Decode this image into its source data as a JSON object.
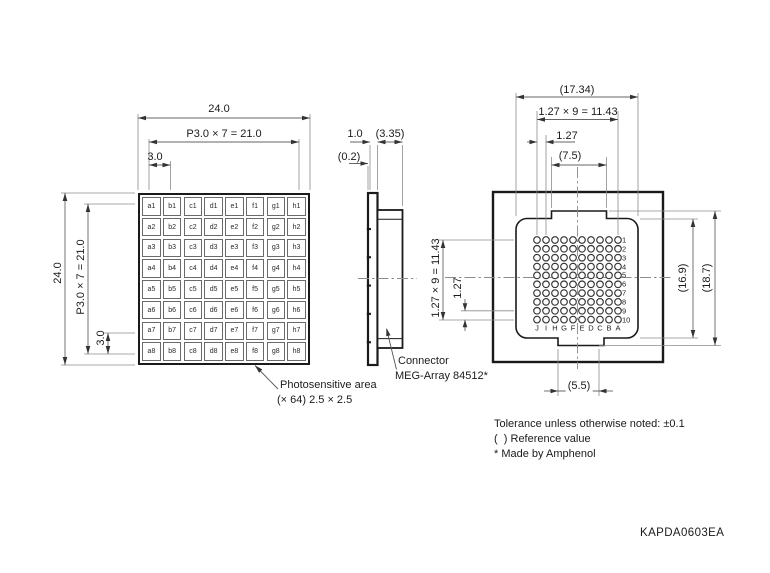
{
  "doc": {
    "drawing_number": "KAPDA0603EA",
    "notes": [
      "Tolerance unless otherwise noted: ±0.1",
      "(  ) Reference value",
      "* Made by Amphenol"
    ]
  },
  "front_view": {
    "dims_top": {
      "overall": "24.0",
      "pitch_total": "P3.0 × 7 = 21.0",
      "pitch": "3.0"
    },
    "dims_left": {
      "overall": "24.0",
      "pitch_total": "P3.0 × 7 = 21.0",
      "pitch": "3.0"
    },
    "cells": [
      [
        "a1",
        "b1",
        "c1",
        "d1",
        "e1",
        "f1",
        "g1",
        "h1"
      ],
      [
        "a2",
        "b2",
        "c2",
        "d2",
        "e2",
        "f2",
        "g2",
        "h2"
      ],
      [
        "a3",
        "b3",
        "c3",
        "d3",
        "e3",
        "f3",
        "g3",
        "h3"
      ],
      [
        "a4",
        "b4",
        "c4",
        "d4",
        "e4",
        "f4",
        "g4",
        "h4"
      ],
      [
        "a5",
        "b5",
        "c5",
        "d5",
        "e5",
        "f5",
        "g5",
        "h5"
      ],
      [
        "a6",
        "b6",
        "c6",
        "d6",
        "e6",
        "f6",
        "g6",
        "h6"
      ],
      [
        "a7",
        "b7",
        "c7",
        "d7",
        "e7",
        "f7",
        "g7",
        "h7"
      ],
      [
        "a8",
        "b8",
        "c8",
        "d8",
        "e8",
        "f8",
        "g8",
        "h8"
      ]
    ],
    "label": {
      "line1": "Photosensitive area",
      "line2": "(× 64) 2.5 × 2.5"
    }
  },
  "side_view": {
    "dims": {
      "thickness": "1.0",
      "window": "(0.2)",
      "connector_depth": "(3.35)"
    },
    "label": {
      "line1": "Connector",
      "line2": "MEG-Array 84512*"
    }
  },
  "back_view": {
    "dims_top": {
      "overall": "(17.34)",
      "pin_span": "1.27 × 9 = 11.43",
      "pin_pitch": "1.27",
      "tab_width": "(7.5)"
    },
    "dims_left": {
      "pin_span": "1.27 × 9 = 11.43",
      "pin_pitch": "1.27"
    },
    "dims_right": {
      "body": "(16.9)",
      "overall": "(18.7)"
    },
    "dims_bottom": {
      "tab_width": "(5.5)"
    },
    "pins": {
      "cols": [
        "J",
        "I",
        "H",
        "G",
        "F",
        "E",
        "D",
        "C",
        "B",
        "A"
      ],
      "rows": [
        "1",
        "2",
        "3",
        "4",
        "5",
        "6",
        "7",
        "8",
        "9",
        "10"
      ]
    }
  }
}
